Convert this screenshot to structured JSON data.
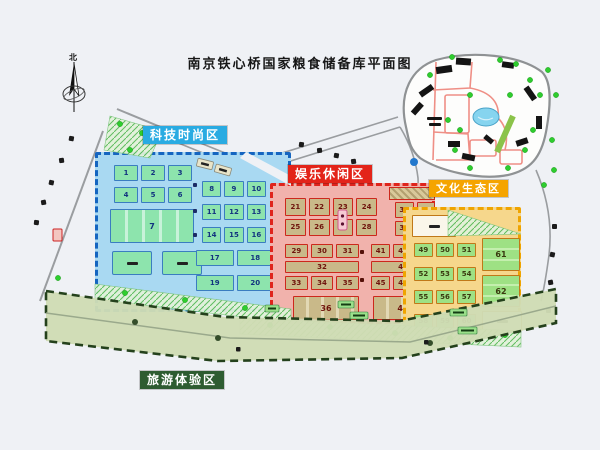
{
  "title": "南京铁心桥国家粮食储备库平面图",
  "compass": {
    "north": "北"
  },
  "zones": {
    "tech": {
      "label": "科技时尚区",
      "label_bg": "#29abe2",
      "fill": "#a9d9f2",
      "border": "#1565c0"
    },
    "entertainment": {
      "label": "娱乐休闲区",
      "label_bg": "#e32419",
      "fill": "#f1b2ac",
      "border": "#df241c"
    },
    "culture": {
      "label": "文化生态区",
      "label_bg": "#f5a400",
      "fill": "#f6d78c",
      "border": "#efa400"
    },
    "tourism": {
      "label": "旅游体验区",
      "label_bg": "#2e5c31",
      "fill": "#cfdcb4",
      "border": "#24411c"
    }
  },
  "buildings": {
    "tech": {
      "r1": [
        "1",
        "2",
        "3"
      ],
      "r2": [
        "4",
        "5",
        "6"
      ],
      "big": "7",
      "g1": [
        "8",
        "9",
        "10"
      ],
      "g2": [
        "11",
        "12",
        "13"
      ],
      "g3": [
        "14",
        "15",
        "16"
      ],
      "w1": [
        "17",
        "18"
      ],
      "w2": [
        "19",
        "20"
      ]
    },
    "entertainment": {
      "a": [
        "21",
        "22",
        "23",
        "24",
        "25",
        "26",
        "27",
        "28"
      ],
      "b": [
        "37",
        "38",
        "39",
        "40"
      ],
      "c_top": [
        "29",
        "30",
        "31"
      ],
      "c_mid": "32",
      "c_bot": [
        "33",
        "34",
        "35"
      ],
      "d_top": [
        "41",
        "42",
        "43"
      ],
      "d_mid": "44",
      "d_bot": [
        "45",
        "46",
        "47"
      ],
      "big_left": "36",
      "big_right": "48"
    },
    "culture": {
      "r1": [
        "49",
        "50",
        "51"
      ],
      "r2": [
        "52",
        "53",
        "54"
      ],
      "r3": [
        "55",
        "56",
        "57"
      ],
      "r4": [
        "58",
        "59",
        "60"
      ],
      "big1": "61",
      "big2": "62"
    }
  }
}
